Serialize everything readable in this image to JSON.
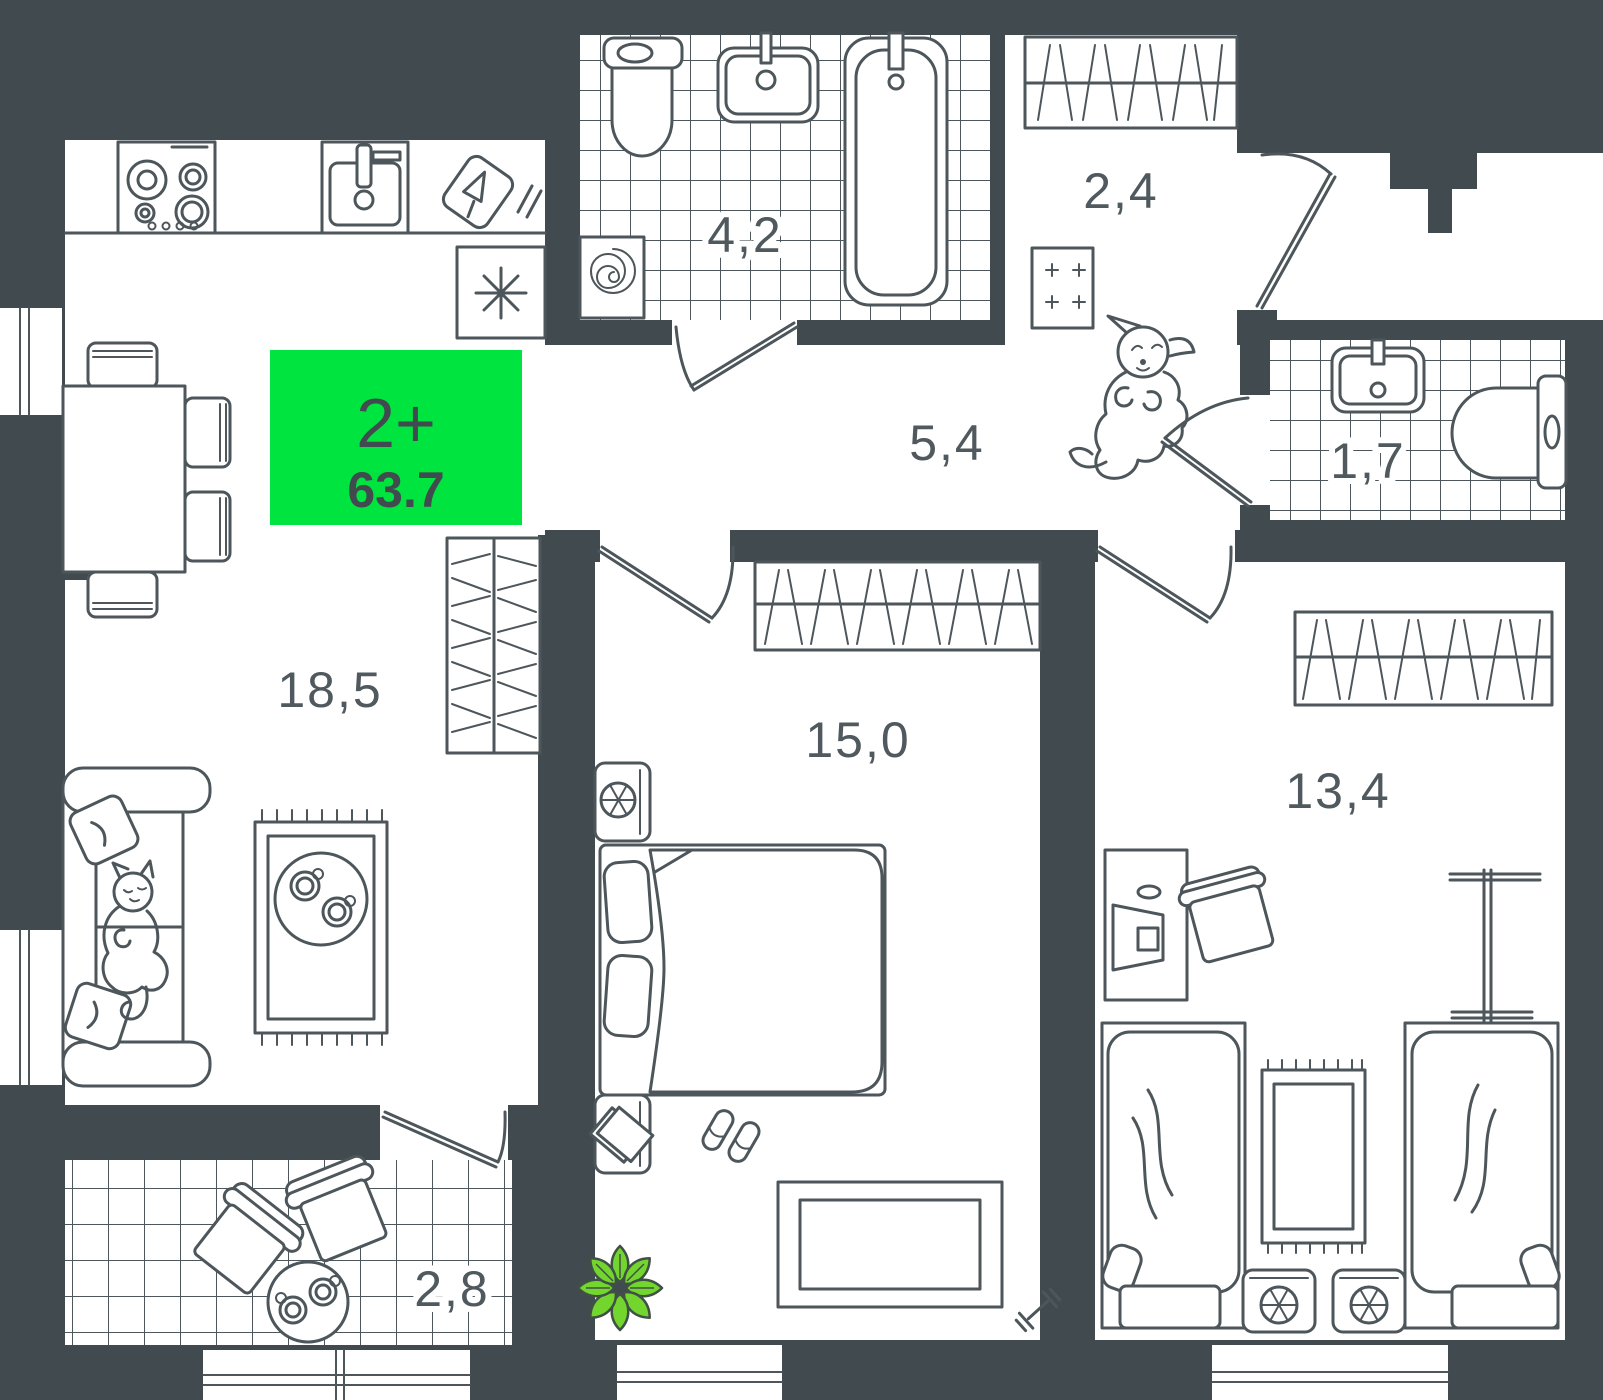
{
  "floorplan": {
    "badge": {
      "type_label": "2+",
      "area_label": "63.7",
      "bg_color": "#00e43f",
      "text_color": "#414a4e"
    },
    "rooms": [
      {
        "name": "kitchen-living-room",
        "area": "18,5"
      },
      {
        "name": "bathroom",
        "area": "4,2"
      },
      {
        "name": "wardrobe-room",
        "area": "2,4"
      },
      {
        "name": "hallway",
        "area": "5,4"
      },
      {
        "name": "toilet-room",
        "area": "1,7"
      },
      {
        "name": "bedroom",
        "area": "15,0"
      },
      {
        "name": "kids-bedroom",
        "area": "13,4"
      },
      {
        "name": "balcony",
        "area": "2,8"
      }
    ],
    "icons": {
      "fridge_symbol": "snowflake-asterisk",
      "washing_machine_symbol": "spiral-drum",
      "bedside_lamp_symbol": "spoked-circle",
      "fitness_symbol": "dumbbell"
    },
    "colors": {
      "wall": "#414a4e",
      "floor": "#ffffff",
      "line": "#4d565b",
      "accent_green": "#00e43f",
      "plant_green": "#72d62f"
    }
  }
}
